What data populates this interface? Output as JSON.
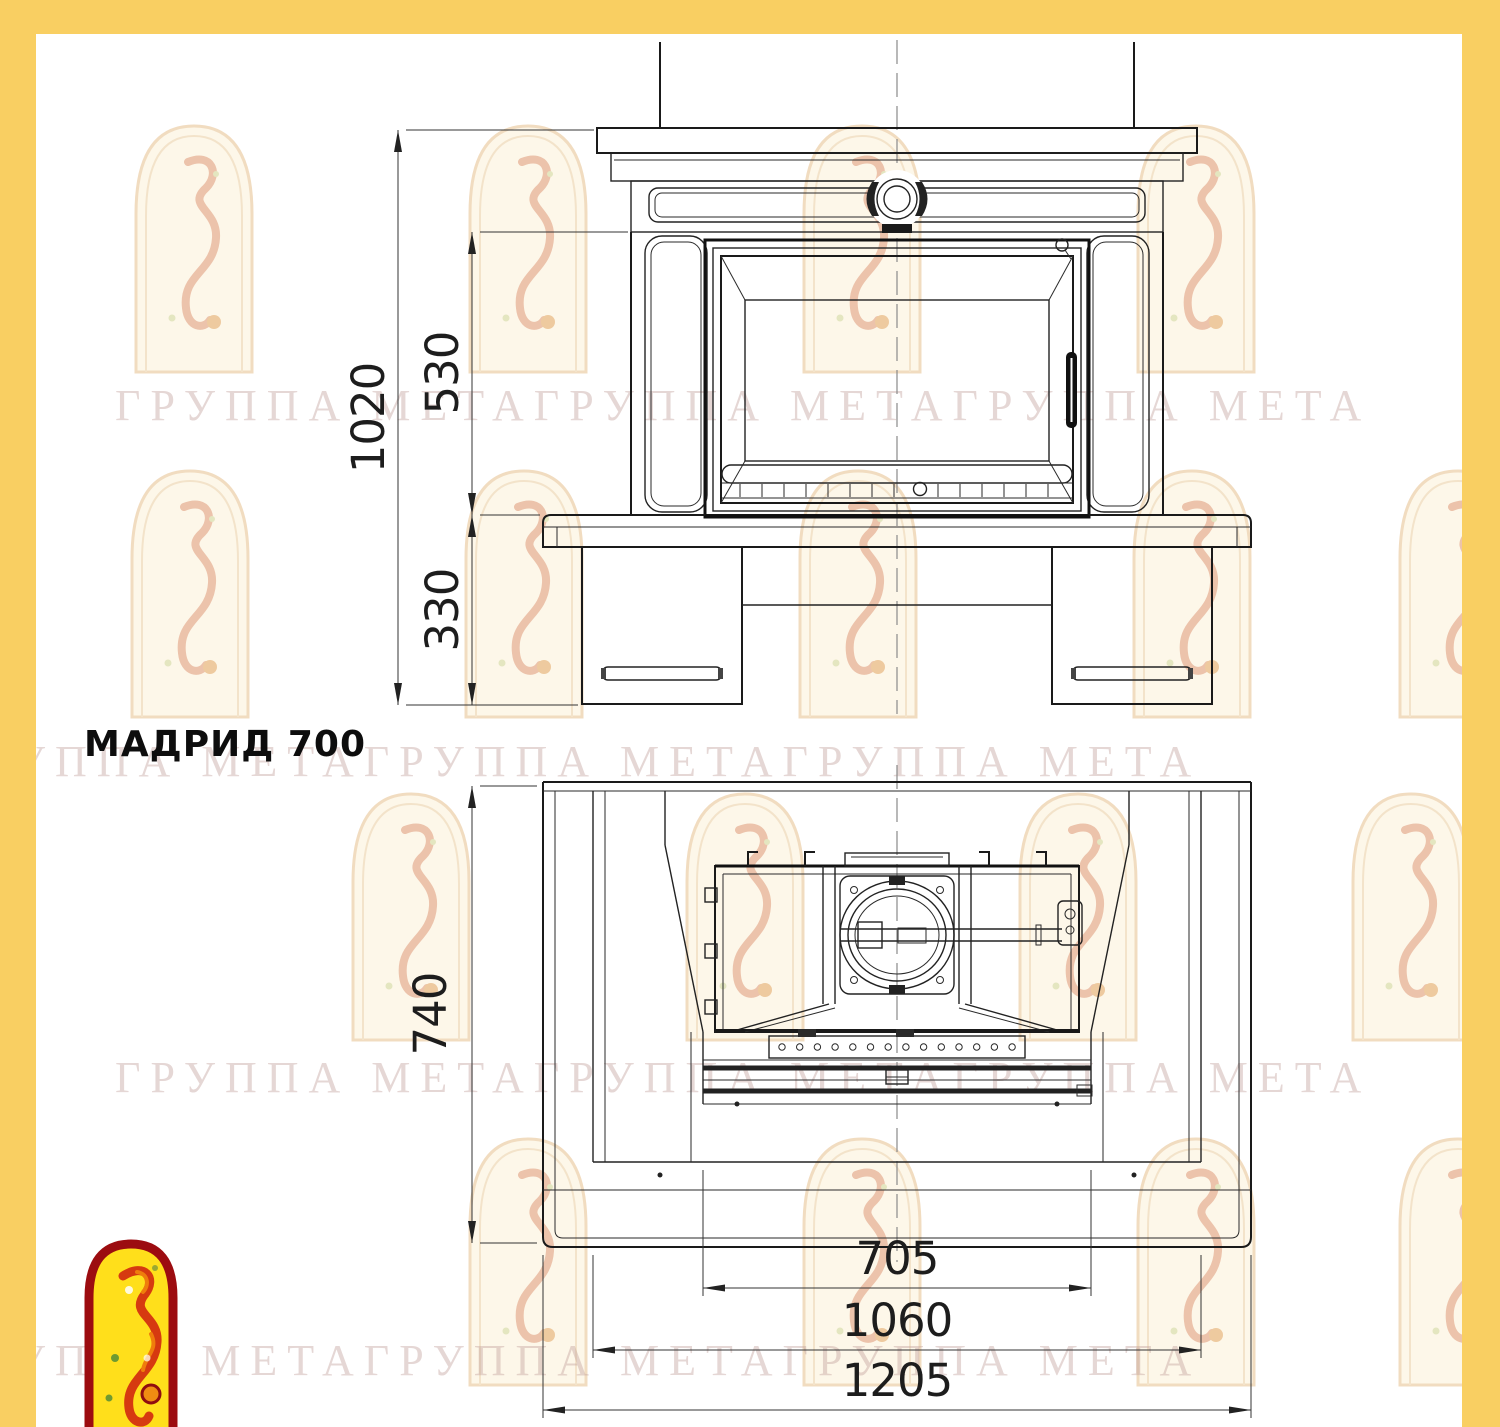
{
  "title": {
    "label": "МАДРИД 700"
  },
  "watermark": {
    "text": "ГРУППА МЕТАГРУППА МЕТАГРУППА МЕТА",
    "logo_name": "meta-arch-firebird-logo"
  },
  "colors": {
    "frame_yellow": "#f9cf62",
    "paper_white": "#ffffff",
    "drawing_line": "#222222",
    "dimension_text": "#1d1d1d",
    "logo_yellow": "#ffdf1b",
    "logo_dark_red": "#9c0c10",
    "watermark_pink": "#c1a09c"
  },
  "front_view": {
    "name": "front-elevation-view",
    "dimensions": {
      "overall_height": "1020",
      "opening_height": "530",
      "base_height": "330"
    }
  },
  "plan_view": {
    "name": "top-plan-view",
    "dimensions": {
      "depth": "740",
      "opening_width": "705",
      "body_width": "1060",
      "overall_width": "1205"
    }
  }
}
